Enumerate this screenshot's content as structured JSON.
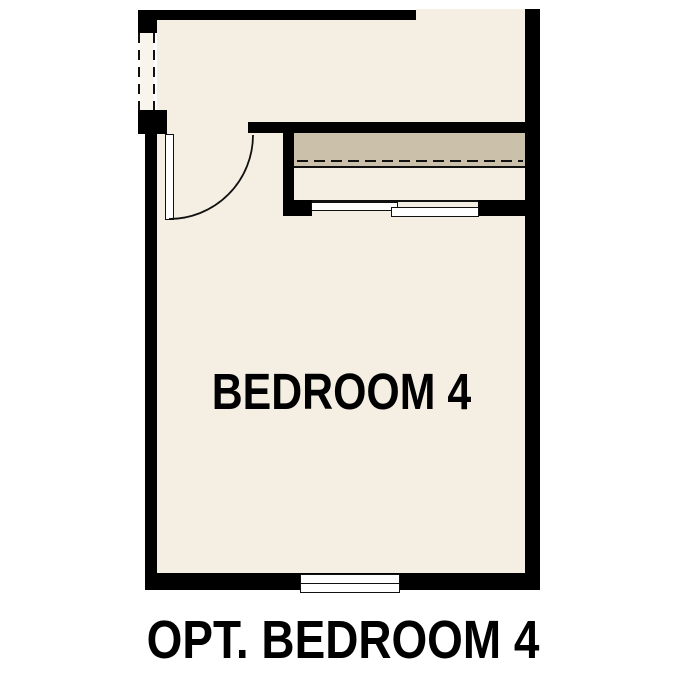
{
  "floor_plan": {
    "room_label": "BEDROOM 4",
    "caption": "OPT. BEDROOM 4"
  },
  "colors": {
    "background": "#ffffff",
    "wall": "#000000",
    "floor": "#f5efe3",
    "opening_floor": "#faf5ec",
    "shelf": "#cbc1aa",
    "line": "#111111",
    "text": "#000000"
  }
}
